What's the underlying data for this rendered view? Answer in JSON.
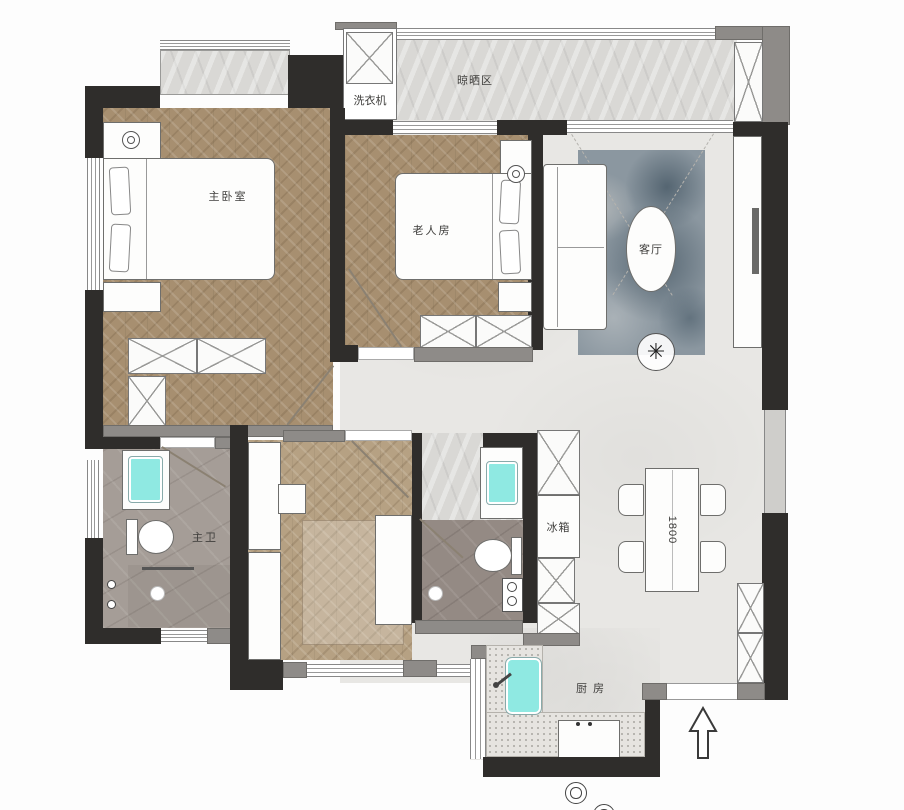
{
  "floorplan": {
    "labels": {
      "drying_area": "晾晒区",
      "washing_machine": "洗衣机",
      "master_bedroom": "主卧室",
      "elder_room": "老人房",
      "living_room": "客厅",
      "master_bath": "主卫",
      "fridge": "冰箱",
      "kitchen": "厨房",
      "dining_table_size": "1800"
    },
    "colors": {
      "wall_dark": "#2f2d2b",
      "wall_gray": "#8e8b88",
      "wood_floor": "#a78f70",
      "tile_floor": "#e8e7e4",
      "bath_tile": "#a59d97",
      "balcony_marble": "#d9d8d5",
      "sink_cyan": "#8fe9e2",
      "rug_blue_gray": "#8b97a0"
    }
  }
}
